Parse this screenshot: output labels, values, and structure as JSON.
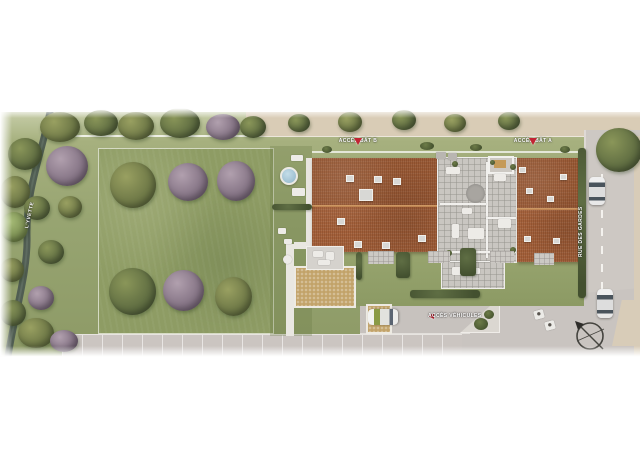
{
  "labels": {
    "acces_bat_b": "ACCÈS BÂT B",
    "acces_bat_a": "ACCÈS BÂT A",
    "acces_vehicules": "ACCÈS VÉHICULES",
    "rue": "RUE DES GARDES",
    "riviere": "L'YVETTE"
  },
  "colors": {
    "accent_red": "#c22433",
    "roof_terracotta": "#a4613b",
    "lawn_green": "#8e9c64",
    "road_gray": "#cdc8c3",
    "sidewalk_beige": "#d9ccb6",
    "river": "#4d5a51",
    "pool_blue": "#8fb4c8"
  },
  "scene": {
    "items": [
      {
        "name": "tree",
        "cls": "tree t-olive",
        "x": 40,
        "y": 112,
        "w": 40,
        "h": 30
      },
      {
        "name": "tree",
        "cls": "tree t-green",
        "x": 84,
        "y": 110,
        "w": 34,
        "h": 26
      },
      {
        "name": "tree",
        "cls": "tree t-olive",
        "x": 118,
        "y": 112,
        "w": 36,
        "h": 28
      },
      {
        "name": "tree",
        "cls": "tree t-green",
        "x": 160,
        "y": 108,
        "w": 40,
        "h": 30
      },
      {
        "name": "tree",
        "cls": "tree t-purple",
        "x": 206,
        "y": 114,
        "w": 34,
        "h": 26
      },
      {
        "name": "tree",
        "cls": "tree t-green",
        "x": 240,
        "y": 116,
        "w": 26,
        "h": 22
      },
      {
        "name": "tree",
        "cls": "tree t-green",
        "x": 288,
        "y": 114,
        "w": 22,
        "h": 18
      },
      {
        "name": "tree",
        "cls": "tree t-olive",
        "x": 338,
        "y": 112,
        "w": 24,
        "h": 20
      },
      {
        "name": "tree",
        "cls": "tree t-green",
        "x": 392,
        "y": 110,
        "w": 24,
        "h": 20
      },
      {
        "name": "tree",
        "cls": "tree t-olive",
        "x": 444,
        "y": 114,
        "w": 22,
        "h": 18
      },
      {
        "name": "tree",
        "cls": "tree t-green",
        "x": 498,
        "y": 112,
        "w": 22,
        "h": 18
      },
      {
        "name": "tree",
        "cls": "tree t-green",
        "x": 596,
        "y": 128,
        "w": 46,
        "h": 44,
        "z": 6
      },
      {
        "name": "tree",
        "cls": "tree t-purple",
        "x": 46,
        "y": 146,
        "w": 42,
        "h": 40
      },
      {
        "name": "tree",
        "cls": "tree t-green",
        "x": 8,
        "y": 138,
        "w": 34,
        "h": 32
      },
      {
        "name": "tree",
        "cls": "tree t-olive",
        "x": 0,
        "y": 176,
        "w": 30,
        "h": 32
      },
      {
        "name": "tree",
        "cls": "tree t-green",
        "x": 24,
        "y": 196,
        "w": 26,
        "h": 24
      },
      {
        "name": "tree",
        "cls": "tree t-light",
        "x": 0,
        "y": 212,
        "w": 28,
        "h": 30
      },
      {
        "name": "tree",
        "cls": "tree t-olive",
        "x": 58,
        "y": 196,
        "w": 24,
        "h": 22
      },
      {
        "name": "tree",
        "cls": "tree t-green",
        "x": 38,
        "y": 240,
        "w": 26,
        "h": 24
      },
      {
        "name": "tree",
        "cls": "tree t-olive",
        "x": 0,
        "y": 258,
        "w": 24,
        "h": 24
      },
      {
        "name": "tree",
        "cls": "tree t-purple",
        "x": 28,
        "y": 286,
        "w": 26,
        "h": 24
      },
      {
        "name": "tree",
        "cls": "tree t-green",
        "x": 0,
        "y": 300,
        "w": 26,
        "h": 26
      },
      {
        "name": "tree",
        "cls": "tree t-olive",
        "x": 18,
        "y": 318,
        "w": 36,
        "h": 30
      },
      {
        "name": "tree",
        "cls": "tree t-purple",
        "x": 50,
        "y": 330,
        "w": 28,
        "h": 22
      },
      {
        "name": "tree",
        "cls": "tree t-olive",
        "x": 110,
        "y": 162,
        "w": 46,
        "h": 46
      },
      {
        "name": "tree",
        "cls": "tree t-purple",
        "x": 168,
        "y": 163,
        "w": 40,
        "h": 38
      },
      {
        "name": "tree",
        "cls": "tree t-purple",
        "x": 217,
        "y": 161,
        "w": 38,
        "h": 40
      },
      {
        "name": "tree",
        "cls": "tree t-green",
        "x": 109,
        "y": 268,
        "w": 47,
        "h": 47
      },
      {
        "name": "tree",
        "cls": "tree t-purple",
        "x": 163,
        "y": 270,
        "w": 41,
        "h": 41
      },
      {
        "name": "tree",
        "cls": "tree t-olive",
        "x": 215,
        "y": 277,
        "w": 37,
        "h": 39
      },
      {
        "name": "skylight",
        "cls": "skylight",
        "x": 346,
        "y": 175,
        "w": 8,
        "h": 7
      },
      {
        "name": "skylight",
        "cls": "skylight",
        "x": 374,
        "y": 176,
        "w": 8,
        "h": 7
      },
      {
        "name": "skylight",
        "cls": "skylight",
        "x": 393,
        "y": 178,
        "w": 8,
        "h": 7
      },
      {
        "name": "skylight",
        "cls": "skylight",
        "x": 359,
        "y": 189,
        "w": 14,
        "h": 12
      },
      {
        "name": "skylight",
        "cls": "skylight",
        "x": 337,
        "y": 218,
        "w": 8,
        "h": 7
      },
      {
        "name": "skylight",
        "cls": "skylight",
        "x": 354,
        "y": 241,
        "w": 8,
        "h": 7
      },
      {
        "name": "skylight",
        "cls": "skylight",
        "x": 382,
        "y": 242,
        "w": 8,
        "h": 7
      },
      {
        "name": "skylight",
        "cls": "skylight",
        "x": 418,
        "y": 235,
        "w": 8,
        "h": 7
      },
      {
        "name": "skylight",
        "cls": "skylight",
        "x": 519,
        "y": 167,
        "w": 7,
        "h": 6
      },
      {
        "name": "skylight",
        "cls": "skylight",
        "x": 560,
        "y": 174,
        "w": 7,
        "h": 6
      },
      {
        "name": "skylight",
        "cls": "skylight",
        "x": 526,
        "y": 188,
        "w": 7,
        "h": 6
      },
      {
        "name": "skylight",
        "cls": "skylight",
        "x": 547,
        "y": 196,
        "w": 7,
        "h": 6
      },
      {
        "name": "skylight",
        "cls": "skylight",
        "x": 524,
        "y": 236,
        "w": 7,
        "h": 6
      },
      {
        "name": "skylight",
        "cls": "skylight",
        "x": 553,
        "y": 238,
        "w": 7,
        "h": 6
      },
      {
        "name": "pool",
        "cls": "pool",
        "x": 280,
        "y": 167,
        "w": 18,
        "h": 18
      },
      {
        "name": "furniture",
        "cls": "furn",
        "x": 291,
        "y": 155,
        "w": 12,
        "h": 6
      },
      {
        "name": "furniture",
        "cls": "furn",
        "x": 292,
        "y": 188,
        "w": 13,
        "h": 8
      },
      {
        "name": "furniture",
        "cls": "furn",
        "x": 278,
        "y": 228,
        "w": 8,
        "h": 6
      },
      {
        "name": "furniture",
        "cls": "furn",
        "x": 284,
        "y": 239,
        "w": 8,
        "h": 5
      },
      {
        "name": "furniture",
        "cls": "furn round",
        "x": 283,
        "y": 255,
        "w": 9,
        "h": 9
      },
      {
        "name": "furniture",
        "cls": "furn",
        "x": 313,
        "y": 251,
        "w": 10,
        "h": 6
      },
      {
        "name": "furniture",
        "cls": "furn",
        "x": 326,
        "y": 252,
        "w": 8,
        "h": 8
      },
      {
        "name": "furniture",
        "cls": "furn",
        "x": 318,
        "y": 260,
        "w": 12,
        "h": 5
      },
      {
        "name": "furniture",
        "cls": "furn",
        "x": 446,
        "y": 167,
        "w": 14,
        "h": 7
      },
      {
        "name": "furniture",
        "cls": "furn",
        "x": 452,
        "y": 224,
        "w": 7,
        "h": 14
      },
      {
        "name": "furniture",
        "cls": "furn",
        "x": 468,
        "y": 228,
        "w": 16,
        "h": 11
      },
      {
        "name": "furniture",
        "cls": "furn",
        "x": 494,
        "y": 174,
        "w": 12,
        "h": 7
      },
      {
        "name": "furniture",
        "cls": "furn",
        "x": 498,
        "y": 219,
        "w": 13,
        "h": 9
      },
      {
        "name": "furniture",
        "cls": "furn",
        "x": 462,
        "y": 208,
        "w": 10,
        "h": 6
      },
      {
        "name": "furniture",
        "cls": "furn",
        "x": 452,
        "y": 267,
        "w": 16,
        "h": 8
      },
      {
        "name": "furniture",
        "cls": "furn",
        "x": 470,
        "y": 268,
        "w": 10,
        "h": 6
      },
      {
        "name": "furniture",
        "cls": "furn gray",
        "x": 436,
        "y": 152,
        "w": 10,
        "h": 7
      },
      {
        "name": "furniture",
        "cls": "furn gray",
        "x": 448,
        "y": 153,
        "w": 9,
        "h": 7
      },
      {
        "name": "furniture",
        "cls": "furn",
        "x": 374,
        "y": 254,
        "w": 8,
        "h": 5
      },
      {
        "name": "furniture",
        "cls": "furn",
        "x": 434,
        "y": 254,
        "w": 7,
        "h": 5
      },
      {
        "name": "furniture",
        "cls": "furn",
        "x": 496,
        "y": 254,
        "w": 8,
        "h": 5
      },
      {
        "name": "shade-disc",
        "cls": "disc",
        "x": 466,
        "y": 184,
        "w": 19,
        "h": 19
      },
      {
        "name": "plant",
        "cls": "plant",
        "x": 452,
        "y": 161,
        "w": 6,
        "h": 6
      },
      {
        "name": "plant",
        "cls": "plant",
        "x": 510,
        "y": 164,
        "w": 6,
        "h": 6
      },
      {
        "name": "plant",
        "cls": "plant",
        "x": 446,
        "y": 250,
        "w": 6,
        "h": 6
      },
      {
        "name": "plant",
        "cls": "plant",
        "x": 510,
        "y": 247,
        "w": 6,
        "h": 6
      },
      {
        "name": "plant",
        "cls": "plant",
        "x": 490,
        "y": 160,
        "w": 5,
        "h": 5
      },
      {
        "name": "plant",
        "cls": "plant",
        "x": 322,
        "y": 146,
        "w": 10,
        "h": 7
      },
      {
        "name": "plant",
        "cls": "plant",
        "x": 420,
        "y": 142,
        "w": 14,
        "h": 8
      },
      {
        "name": "plant",
        "cls": "plant",
        "x": 470,
        "y": 144,
        "w": 12,
        "h": 7
      },
      {
        "name": "plant",
        "cls": "plant",
        "x": 560,
        "y": 146,
        "w": 10,
        "h": 7
      },
      {
        "name": "plant",
        "cls": "plant",
        "x": 474,
        "y": 318,
        "w": 14,
        "h": 12,
        "z": 6
      },
      {
        "name": "plant",
        "cls": "plant",
        "x": 484,
        "y": 310,
        "w": 10,
        "h": 9,
        "z": 6
      },
      {
        "name": "patio",
        "cls": "patio",
        "x": 368,
        "y": 251,
        "w": 26,
        "h": 13
      },
      {
        "name": "patio",
        "cls": "patio",
        "x": 428,
        "y": 251,
        "w": 22,
        "h": 12
      },
      {
        "name": "patio",
        "cls": "patio",
        "x": 490,
        "y": 251,
        "w": 24,
        "h": 12
      },
      {
        "name": "patio",
        "cls": "patio",
        "x": 534,
        "y": 253,
        "w": 20,
        "h": 12
      },
      {
        "name": "hedge",
        "cls": "hedge",
        "x": 272,
        "y": 204,
        "w": 40,
        "h": 6
      },
      {
        "name": "hedge",
        "cls": "hedge",
        "x": 578,
        "y": 148,
        "w": 8,
        "h": 150
      },
      {
        "name": "hedge",
        "cls": "hedge",
        "x": 356,
        "y": 252,
        "w": 6,
        "h": 28
      },
      {
        "name": "hedge",
        "cls": "hedge",
        "x": 396,
        "y": 252,
        "w": 14,
        "h": 26
      },
      {
        "name": "hedge",
        "cls": "hedge",
        "x": 460,
        "y": 248,
        "w": 16,
        "h": 28
      },
      {
        "name": "hedge",
        "cls": "hedge",
        "x": 410,
        "y": 290,
        "w": 70,
        "h": 8
      },
      {
        "name": "car",
        "cls": "car",
        "x": 589,
        "y": 177,
        "w": 16,
        "h": 28,
        "z": 6
      },
      {
        "name": "car",
        "cls": "car",
        "x": 597,
        "y": 289,
        "w": 16,
        "h": 29,
        "z": 6
      },
      {
        "name": "car",
        "cls": "car car-green",
        "x": 375,
        "y": 302,
        "w": 16,
        "h": 30,
        "rot": -90,
        "z": 6
      },
      {
        "name": "road-arrow-marking",
        "cls": "road-mark",
        "x": 534,
        "y": 310,
        "w": 10,
        "h": 9,
        "rot": -15
      },
      {
        "name": "road-arrow-marking",
        "cls": "road-mark",
        "x": 545,
        "y": 321,
        "w": 10,
        "h": 9,
        "rot": -15
      }
    ]
  }
}
